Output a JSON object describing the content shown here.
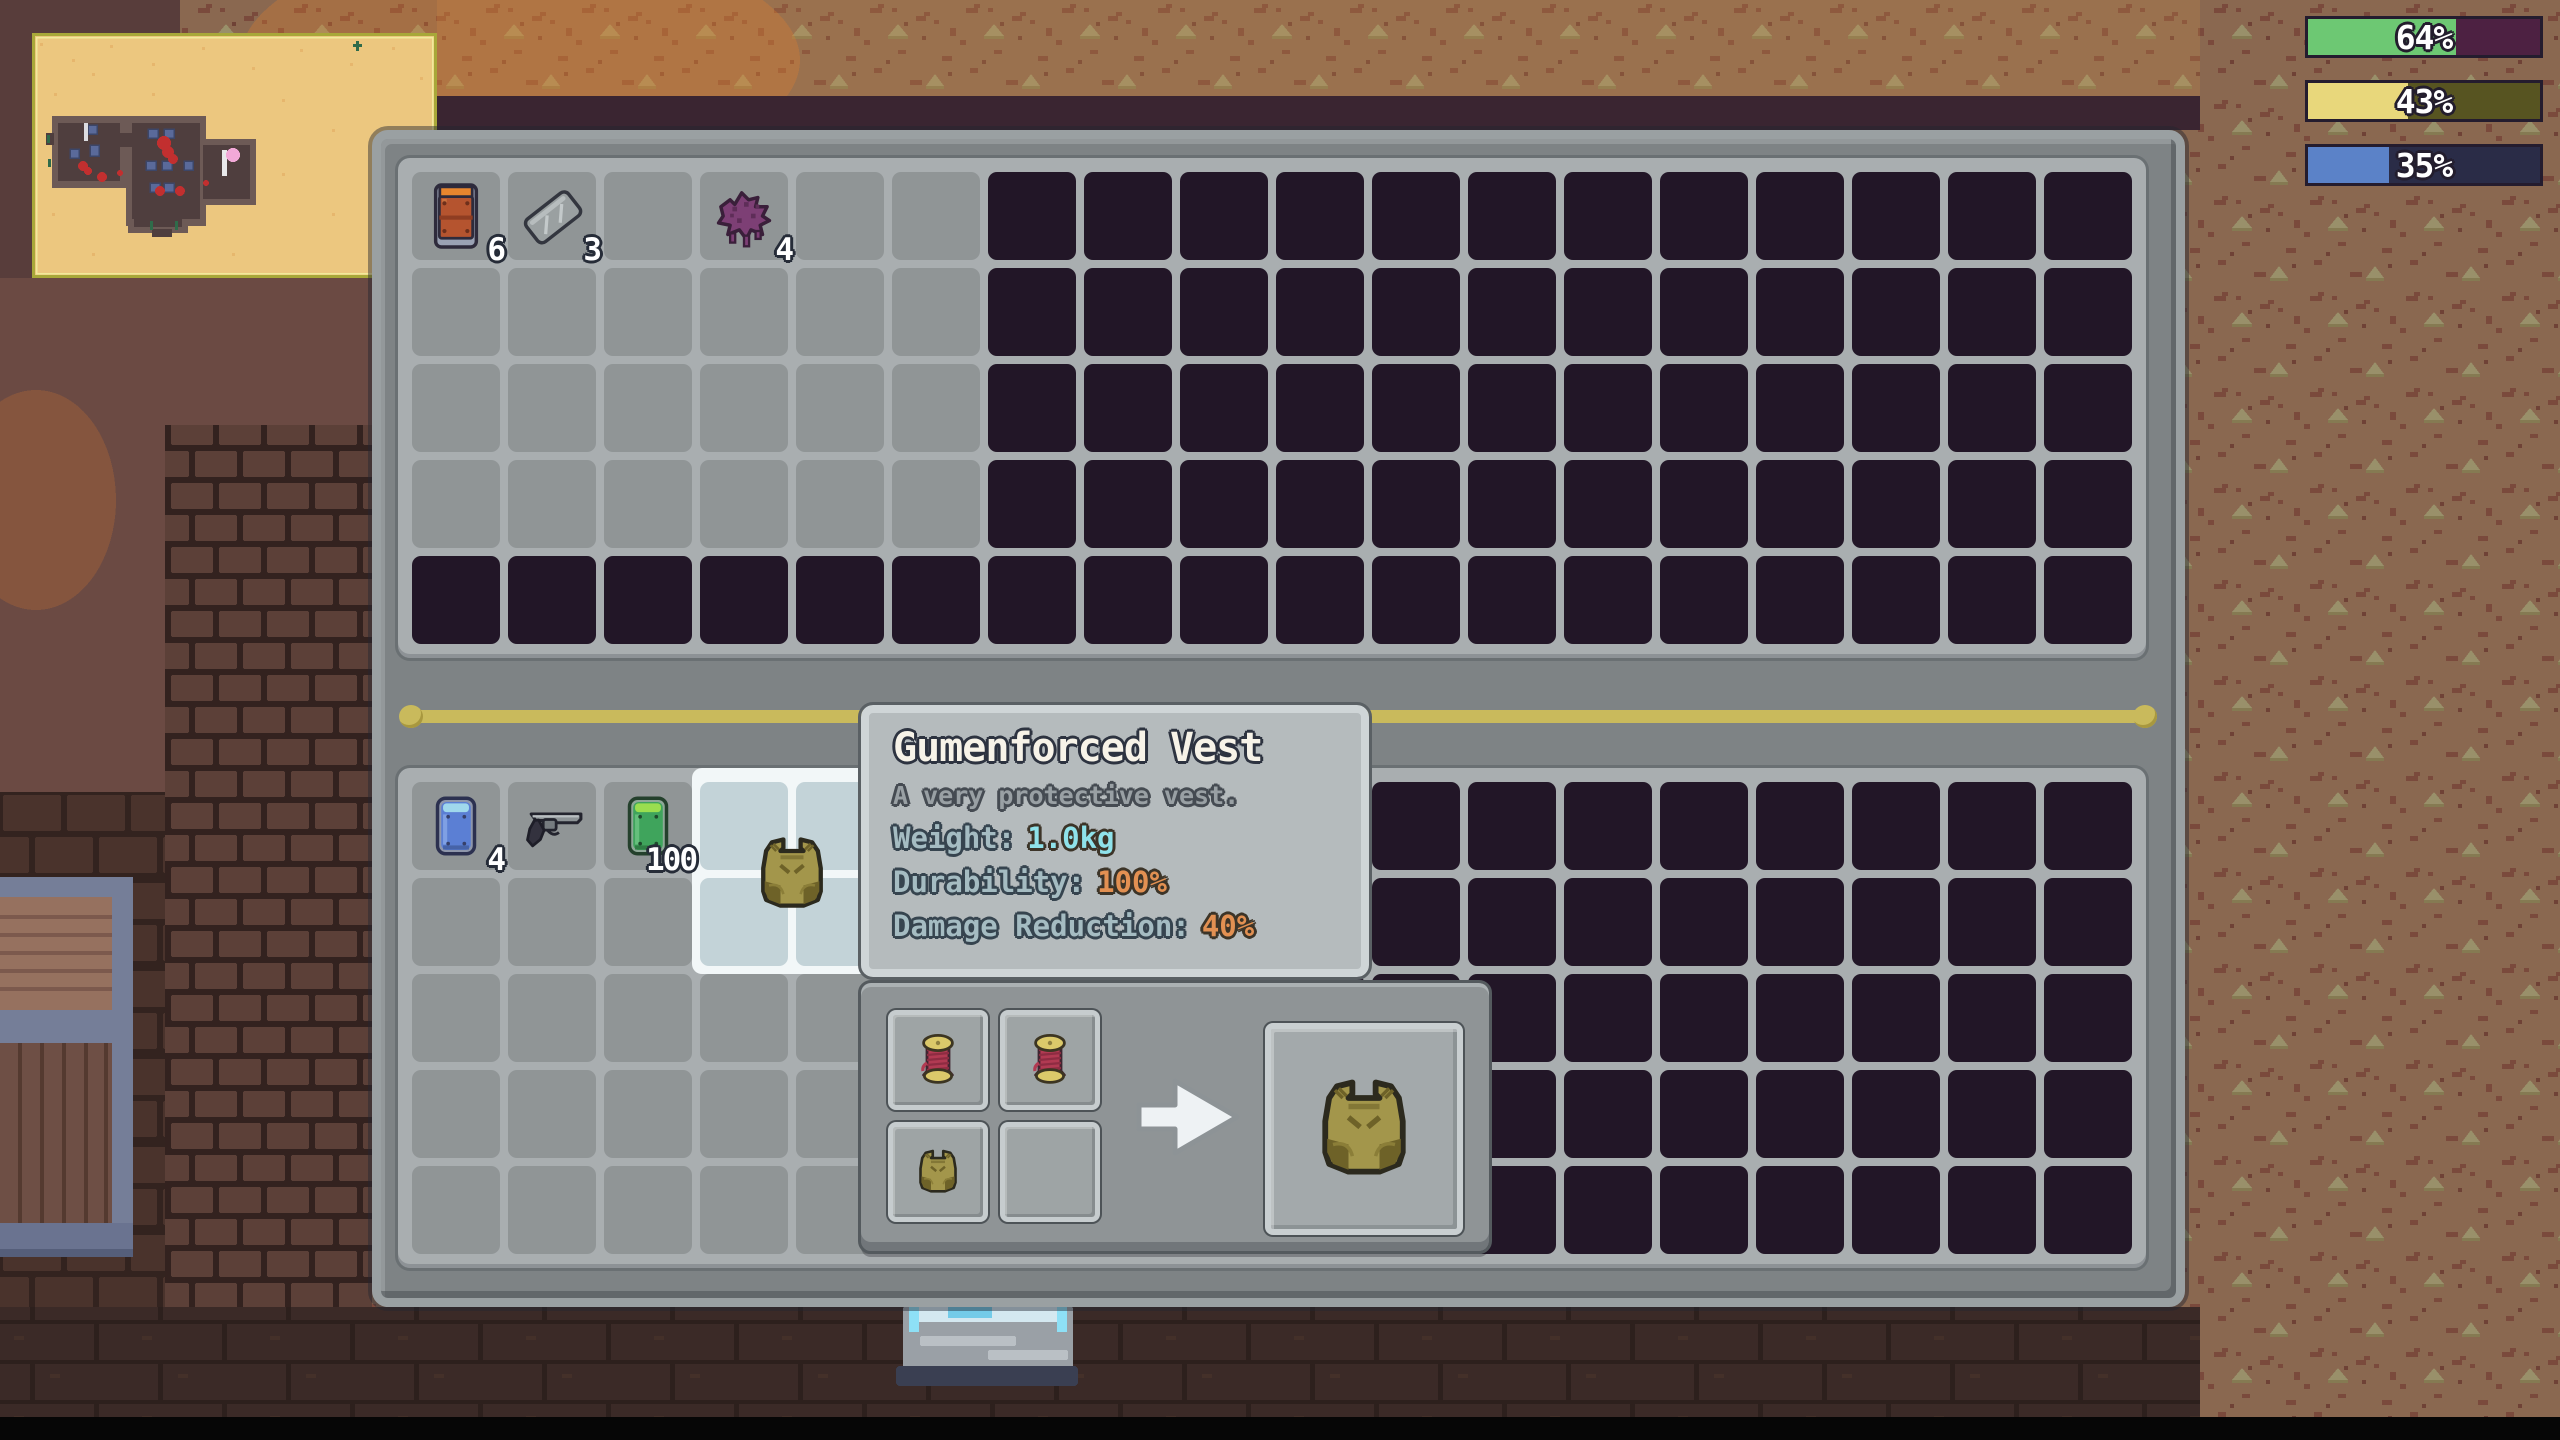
{
  "hud": {
    "bars": [
      {
        "name": "green-stat-bar",
        "label": "64%",
        "percent": 64,
        "fill_color": "#6dc873",
        "track_color": "#4d2142"
      },
      {
        "name": "yellow-stat-bar",
        "label": "43%",
        "percent": 43,
        "fill_color": "#e8d77b",
        "track_color": "#575421"
      },
      {
        "name": "blue-stat-bar",
        "label": "35%",
        "percent": 35,
        "fill_color": "#5b82c8",
        "track_color": "#2a2c47"
      }
    ]
  },
  "inventory": {
    "top_grid": {
      "cols": 18,
      "rows": 5,
      "unlocked": [
        {
          "r0": 0,
          "r1": 3,
          "c0": 0,
          "c1": 5
        }
      ],
      "items": [
        {
          "row": 0,
          "col": 0,
          "icon": "orange-canister",
          "count": "6"
        },
        {
          "row": 0,
          "col": 1,
          "icon": "metal-sheet",
          "count": "3"
        },
        {
          "row": 0,
          "col": 3,
          "icon": "purple-goo",
          "count": "4"
        }
      ]
    },
    "bottom_grid": {
      "cols": 18,
      "rows": 5,
      "unlocked": [
        {
          "r0": 0,
          "r1": 4,
          "c0": 0,
          "c1": 4
        }
      ],
      "highlight": {
        "r0": 0,
        "r1": 1,
        "c0": 3,
        "c1": 4
      },
      "items": [
        {
          "row": 0,
          "col": 0,
          "icon": "blue-can",
          "count": "4"
        },
        {
          "row": 0,
          "col": 1,
          "icon": "revolver"
        },
        {
          "row": 0,
          "col": 2,
          "icon": "green-can",
          "count": "100"
        },
        {
          "row": 0,
          "col": 3,
          "icon": "vest",
          "span": 2
        }
      ]
    }
  },
  "tooltip": {
    "title": "Gumenforced Vest",
    "description": "A very protective vest.",
    "stats": [
      {
        "label": "Weight:",
        "value": "1.0kg",
        "value_color": "#8fe2ea"
      },
      {
        "label": "Durability:",
        "value": "100%",
        "value_color": "#e29052"
      },
      {
        "label": "Damage Reduction:",
        "value": "40%",
        "value_color": "#e29052"
      }
    ]
  },
  "crafting": {
    "ingredient_icons": [
      "thread-spool",
      "thread-spool",
      "vest",
      ""
    ],
    "result_icon": "vest"
  },
  "colors": {
    "panel": "#7e8385",
    "slot": "#909596",
    "locked_slot": "#221627",
    "hover_slot": "#c3d3d8",
    "divider": "#c9ba5c",
    "tooltip_bg": "#b5bbbd"
  }
}
